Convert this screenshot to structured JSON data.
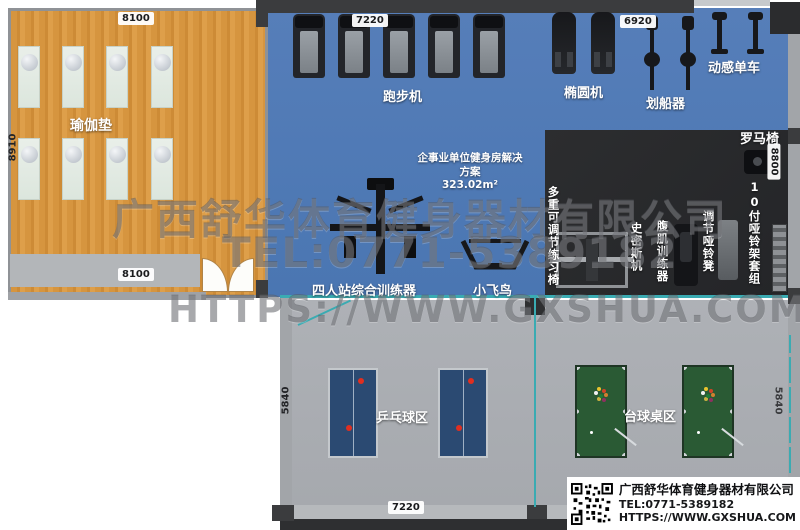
{
  "watermark": {
    "line1": "广西舒华体育健身器材有限公司",
    "line2": "TEL:0771-5389182",
    "line3": "HTTPS://WWW.GXSHUA.COM"
  },
  "info_box": {
    "company": "广西舒华体育健身器材有限公司",
    "tel": "TEL:0771-5389182",
    "url": "HTTPS://WWW.GXSHUA.COM"
  },
  "yoga_room": {
    "label": "瑜伽垫",
    "dim_top": "8100",
    "dim_bottom": "8100",
    "dim_left": "8910"
  },
  "cardio_zone": {
    "dim_top": "7220",
    "treadmill_label": "跑步机",
    "elliptical_label": "椭圆机",
    "rower_label": "划船器",
    "rower_dim": "6920",
    "bike_label": "动感单车",
    "plan_line1": "企事业单位健身房解决",
    "plan_line2": "方案",
    "plan_area": "323.02m²",
    "trainer_label": "四人站综合训练器",
    "fly_label": "小飞鸟"
  },
  "strength_zone": {
    "roman_chair": "罗马椅",
    "dim_right": "8800",
    "dumbbell_rack": "10付哑铃架套组",
    "dumbbell_bench": "调节哑铃凳",
    "ab_trainer": "腹肌训练器",
    "smith_machine": "史密斯机",
    "multi_bench": "多重可调节练习椅"
  },
  "games_room": {
    "pingpong_label": "乒乓球区",
    "billiard_label": "台球桌区",
    "dim_left": "5840",
    "dim_right": "5840",
    "dim_bottom": "7220"
  },
  "colors": {
    "floor_yoga": "#d6953f",
    "floor_cardio": "#4e7ab5",
    "floor_strength": "#2a2b2d",
    "floor_games": "#aaadb2",
    "partition_teal": "#3aabb2",
    "wall_dark": "#3b3c3e"
  }
}
